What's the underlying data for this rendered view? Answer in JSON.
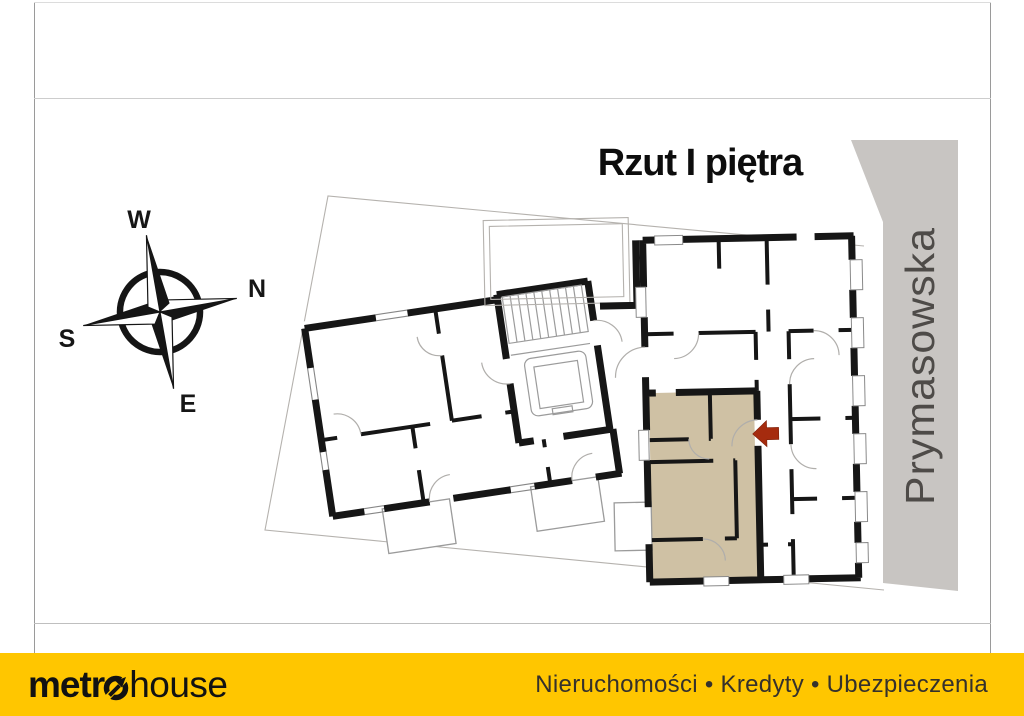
{
  "header": {
    "title": "Rzut I piętra"
  },
  "compass": {
    "w": "W",
    "n": "N",
    "s": "S",
    "e": "E"
  },
  "street": {
    "name": "Prymasowska"
  },
  "plan": {
    "highlighted_unit": "apartment-on-first-floor",
    "highlight_meaning": "offered apartment marked in beige with red entrance arrow"
  },
  "footer": {
    "logo_bold": "metr",
    "logo_light": "house",
    "tagline": "Nieruchomości • Kredyty • Ubezpieczenia"
  },
  "colors": {
    "yellow": "#ffc600",
    "beige": "#cfc1a4",
    "arrow": "#a52b0e",
    "band": "#c8c5c2",
    "wall": "#161616",
    "street-text": "#4e4b48",
    "tagline": "#35312c"
  }
}
